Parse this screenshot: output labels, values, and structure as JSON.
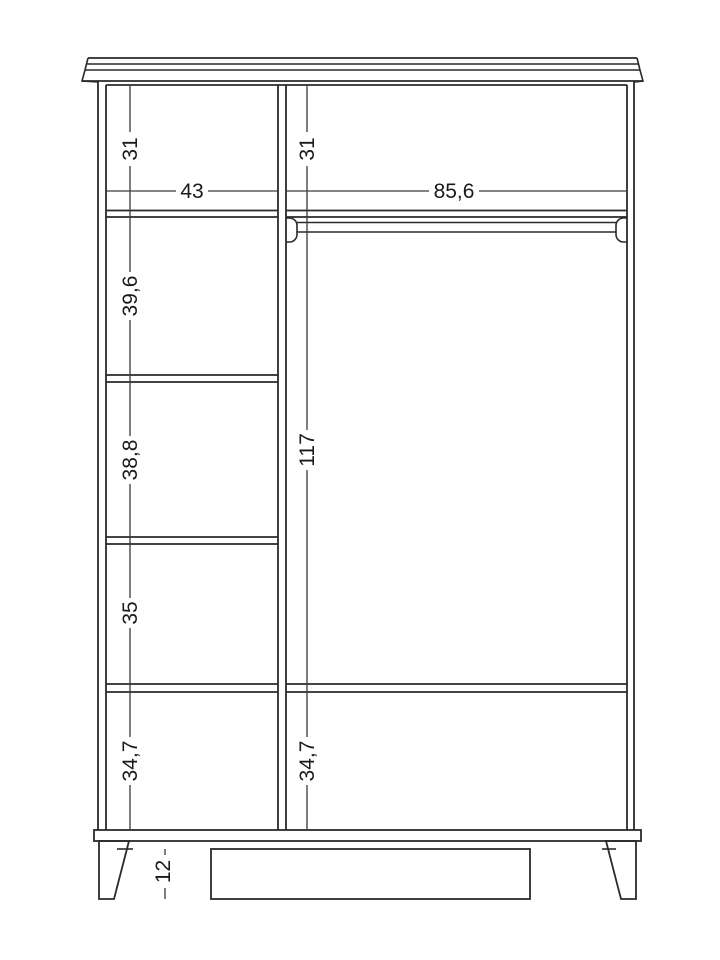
{
  "figure": {
    "kind": "furniture technical drawing",
    "subject": "wardrobe front section with internal dimensions",
    "background_color": "#ffffff",
    "line_color": "#2a2a2a"
  },
  "labels": {
    "left_top_section": "31",
    "right_top_section": "31",
    "left_column_width": "43",
    "right_column_width": "85,6",
    "left_section_2": "39,6",
    "left_section_3": "38,8",
    "left_section_4": "35",
    "left_section_5": "34,7",
    "right_hanging_section": "117",
    "right_bottom_section": "34,7",
    "leg_height": "12"
  },
  "structure": {
    "left_column_sections_top_to_bottom": [
      "31",
      "39,6",
      "38,8",
      "35",
      "34,7"
    ],
    "right_column_sections_top_to_bottom": [
      "31",
      "117",
      "34,7"
    ],
    "column_inner_widths_left_to_right": [
      "43",
      "85,6"
    ],
    "leg_height": "12",
    "features": [
      "crown cornice",
      "center partition",
      "four shelves in left column",
      "clothes hanging rail in right column",
      "full-width bottom shelf",
      "tapered front legs",
      "recessed base rail"
    ]
  }
}
